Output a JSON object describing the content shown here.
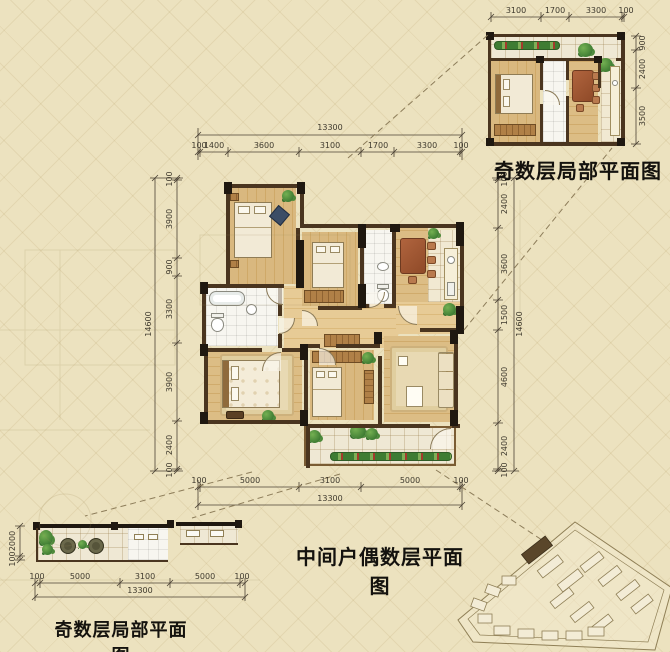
{
  "titles": {
    "main": "中间户偶数层平面图",
    "top_partial": "奇数层局部平面图",
    "bottom_partial": "奇数层局部平面图"
  },
  "main_plan": {
    "dims_top": {
      "total": "13300",
      "segments": [
        "100",
        "1400",
        "3600",
        "3100",
        "1700",
        "3300",
        "100"
      ]
    },
    "dims_bottom": {
      "total": "13300",
      "segments": [
        "100",
        "5000",
        "3100",
        "5000",
        "100"
      ]
    },
    "dims_left": {
      "total": "14600",
      "segments": [
        "100",
        "3900",
        "900",
        "3300",
        "3900",
        "2400",
        "100"
      ]
    },
    "dims_right": {
      "total": "14600",
      "segments": [
        "100",
        "2400",
        "3600",
        "1500",
        "4600",
        "2400",
        "100"
      ]
    }
  },
  "top_partial": {
    "dims_top": {
      "segments": [
        "3100",
        "1700",
        "3300",
        "100"
      ]
    },
    "dims_right": {
      "segments": [
        "900",
        "2400",
        "3500"
      ]
    }
  },
  "bottom_partial": {
    "dims_bottom": {
      "total": "13300",
      "segments": [
        "100",
        "5000",
        "3100",
        "5000",
        "100"
      ]
    },
    "dims_left": {
      "segments": [
        "2000",
        "100"
      ]
    }
  },
  "colors": {
    "background": "#ece2bf",
    "wall": "#4a351f",
    "wall_dark": "#1f1810",
    "wood": "#d9b87f",
    "tile": "#f7f6f0",
    "dim_text": "#3f3a2e",
    "title_text": "#14120e",
    "plant_green": "#3e7c33",
    "flower_red": "#a33b2c",
    "dining_table": "#a25634",
    "site_highlight": "#5a462a"
  }
}
